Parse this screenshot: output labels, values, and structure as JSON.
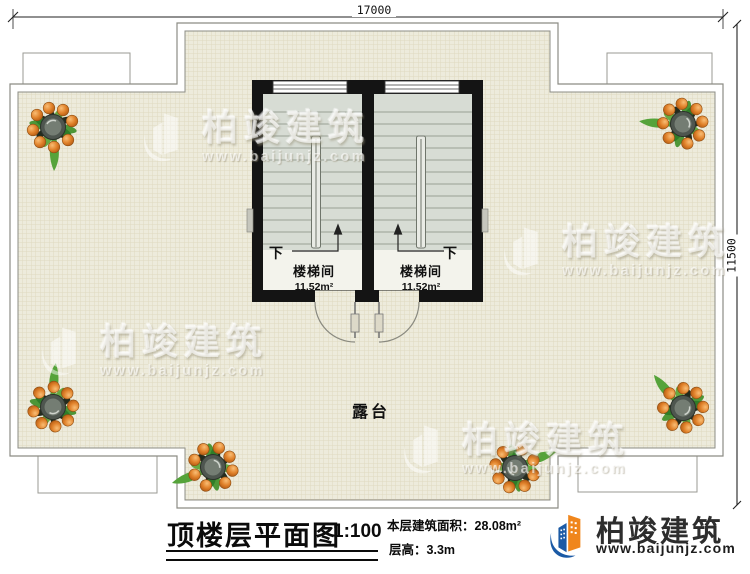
{
  "plan": {
    "dim_top": "17000",
    "dim_right": "11500",
    "terrace_label": "露台",
    "stairwells": [
      {
        "name": "楼梯间",
        "area": "11.52m²",
        "direction": "下"
      },
      {
        "name": "楼梯间",
        "area": "11.52m²",
        "direction": "下"
      }
    ]
  },
  "watermark": {
    "brand": "柏竣建筑",
    "website": "www.baijunjz.com"
  },
  "title_block": {
    "title": "顶楼层平面图",
    "scale": "1:100",
    "area_label": "本层建筑面积：",
    "area_value": "28.08m²",
    "height_label": "层高：",
    "height_value": "3.3m"
  },
  "brand": {
    "name": "柏竣建筑",
    "website": "www.baijunjz.com",
    "blue": "#1b5aa5",
    "orange": "#f0861c",
    "text_dark": "#2d2d2d"
  },
  "palette": {
    "terrace_tile": "#edebdc",
    "tile_grid_line": "#dfd9c0",
    "stair_fill": "#d7dcd4",
    "wall_black": "#141414",
    "fruit_orange": "#e0812a",
    "leaf_green": "#4d9637"
  }
}
